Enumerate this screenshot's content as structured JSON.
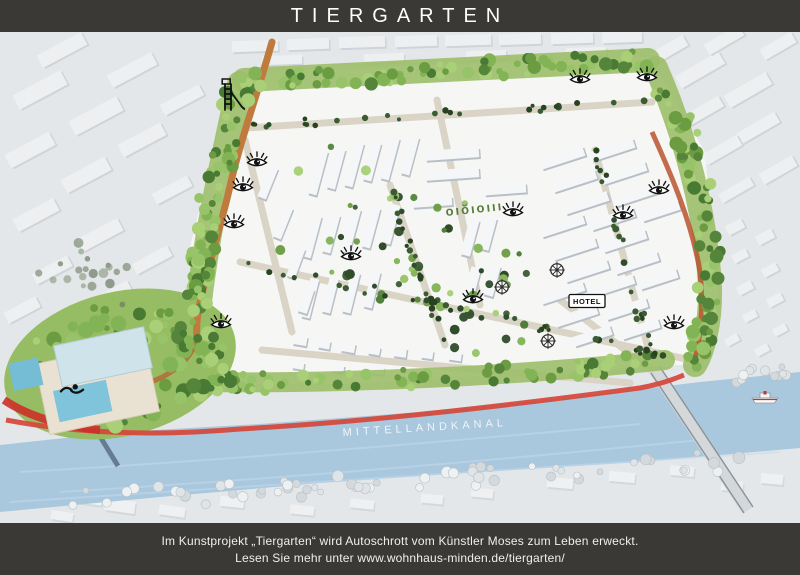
{
  "header": {
    "title": "TIERGARTEN"
  },
  "footer": {
    "line1": "Im Kunstprojekt „Tiergarten“ wird Autoschrott vom Künstler Moses zum Leben erweckt.",
    "line2": "Lesen Sie mehr unter www.wohnhaus-minden.de/tiergarten/"
  },
  "map": {
    "canal_label": "MITTELLANDKANAL",
    "hotel_label": "HOTEL",
    "hedge_text": "oıŏıoııı",
    "colors": {
      "bar": "#3a3935",
      "ground": "#e4e7e9",
      "district": "#f6f7f4",
      "water": "#a9c7dd",
      "green_belt": "#9cbe69",
      "dirt_path": "#bf7a3e",
      "red_path": "#d6463a",
      "street": "#d9d4c6"
    },
    "markers": {
      "eyes": [
        {
          "x": 257,
          "y": 128
        },
        {
          "x": 243,
          "y": 153
        },
        {
          "x": 234,
          "y": 190
        },
        {
          "x": 221,
          "y": 290
        },
        {
          "x": 351,
          "y": 222
        },
        {
          "x": 473,
          "y": 265
        },
        {
          "x": 513,
          "y": 178
        },
        {
          "x": 580,
          "y": 45
        },
        {
          "x": 647,
          "y": 43
        },
        {
          "x": 659,
          "y": 156
        },
        {
          "x": 623,
          "y": 181
        },
        {
          "x": 674,
          "y": 291
        }
      ],
      "wheels": [
        {
          "x": 557,
          "y": 238
        },
        {
          "x": 502,
          "y": 255
        },
        {
          "x": 548,
          "y": 309
        }
      ],
      "ladder": {
        "x": 233,
        "y": 63
      },
      "swimmer": {
        "x": 72,
        "y": 358
      },
      "boat": {
        "x": 765,
        "y": 366
      },
      "hotel": {
        "x": 587,
        "y": 269
      },
      "canal_label_pos": {
        "x": 425,
        "y": 399
      },
      "hedge_pos": {
        "x": 446,
        "y": 184
      }
    }
  }
}
